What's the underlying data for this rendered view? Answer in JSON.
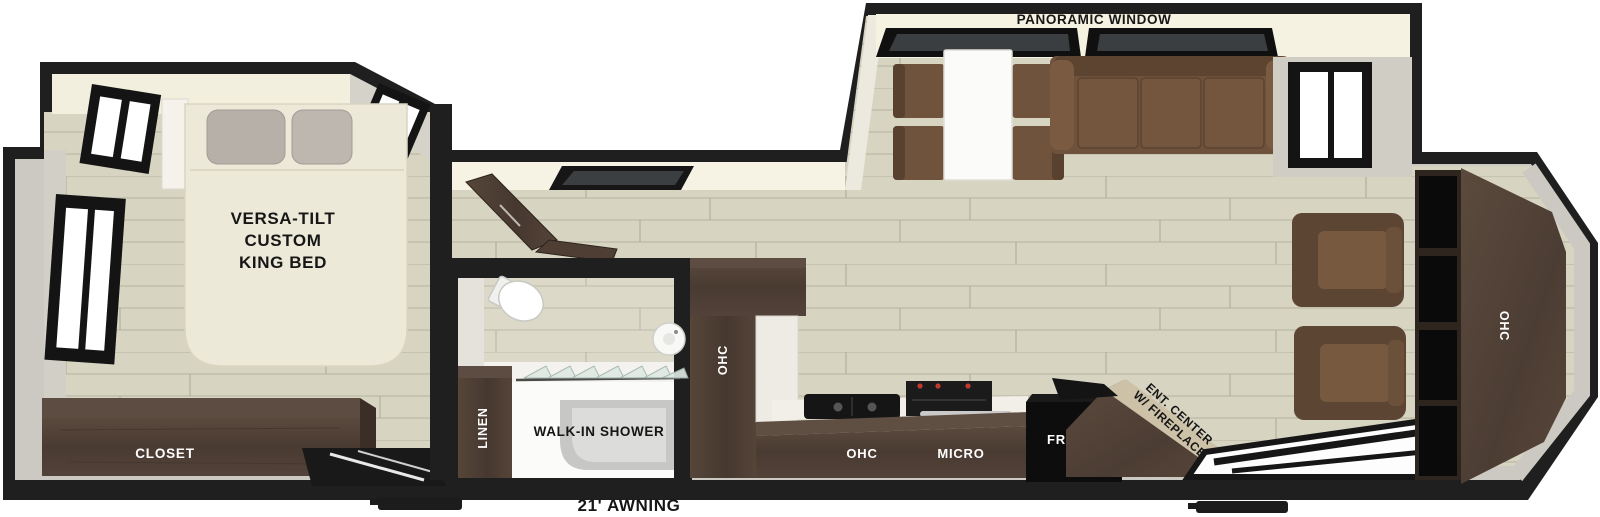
{
  "title": "Travel trailer floor plan - rear living with versa-tilt king bed",
  "labels": {
    "panoramic_window": "PANORAMIC WINDOW",
    "bed": [
      "VERSA-TILT",
      "CUSTOM",
      "KING BED"
    ],
    "closet": "CLOSET",
    "linen": "LINEN",
    "walk_in_shower": "WALK-IN SHOWER",
    "ohc_pantry": "OHC",
    "ohc_kitchen": "OHC",
    "micro": "MICRO",
    "fridge": "FRIDGE",
    "ent_center": [
      "ENT. CENTER",
      "W/ FIREPLACE"
    ],
    "ohc_rear": "OHC",
    "awning": "21' AWNING"
  },
  "colors": {
    "wall_black": "#1f1f1f",
    "floor_plank": "#d8d4c2",
    "interior_margin": "#ccc9c2",
    "ceiling_cream": "#f5f2e2",
    "wood_dark": "#4a3b32",
    "sofa_brown": "#6e523c",
    "bed_cream": "#ece9d8",
    "appliance_black": "#111111",
    "label_light": "#ffffff",
    "label_dark": "#161616"
  }
}
